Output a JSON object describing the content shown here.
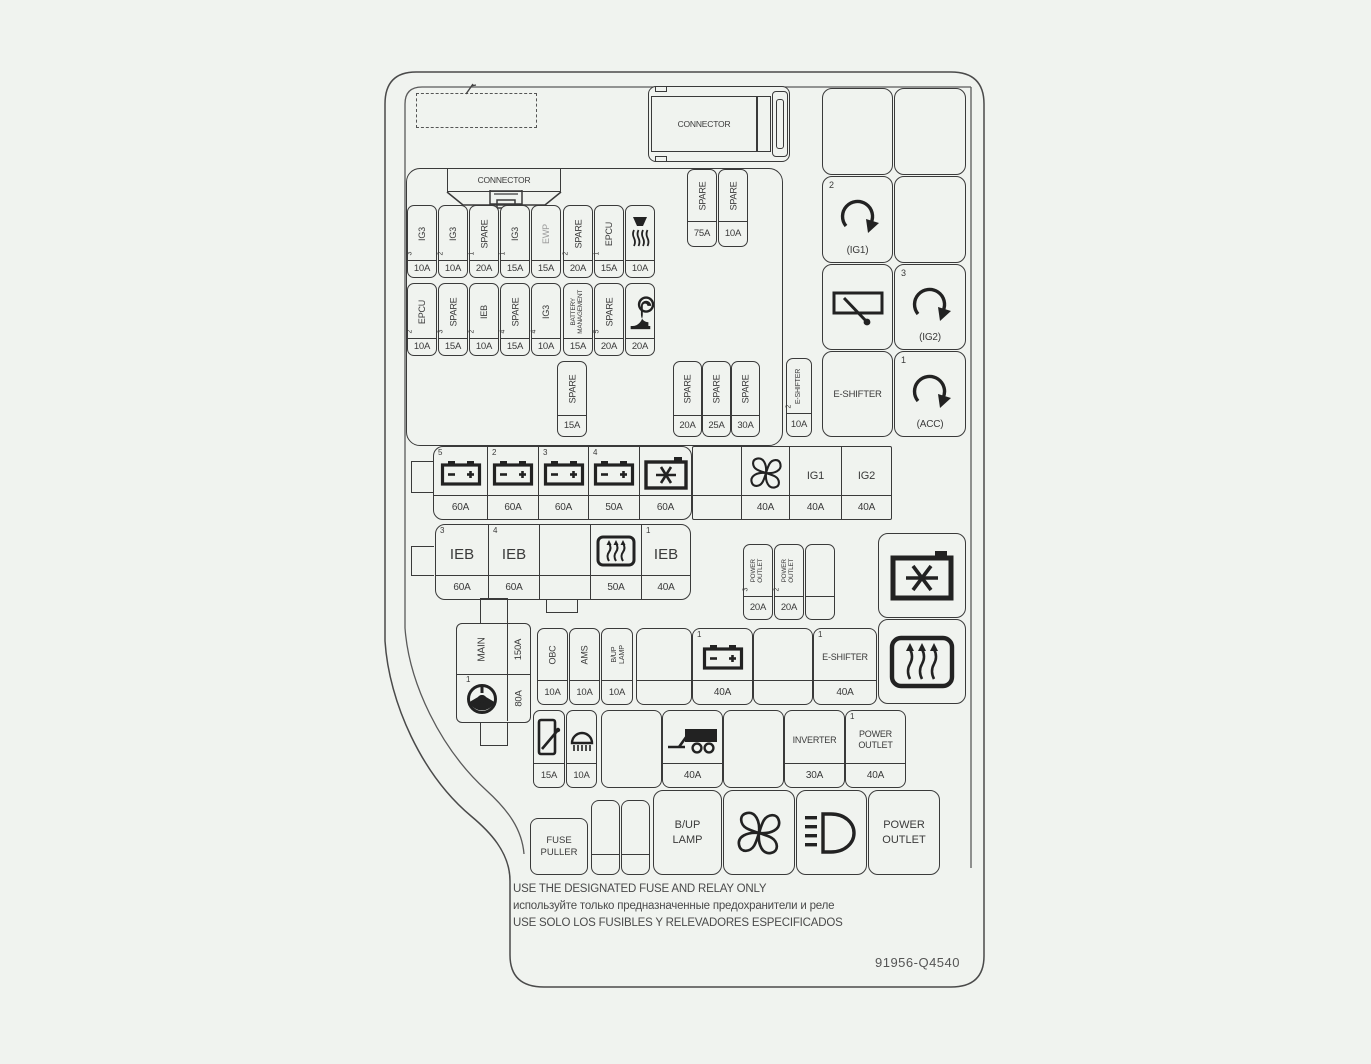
{
  "colors": {
    "background": "#f0f3ef",
    "line": "#3a3a3a",
    "muted_label": "#9a9a9a"
  },
  "connectors": {
    "top_label": "CONNECTOR",
    "inner_label": "CONNECTOR"
  },
  "spare_top": [
    {
      "label": "SPARE",
      "amp": "75A"
    },
    {
      "label": "SPARE",
      "amp": "10A"
    }
  ],
  "row1": [
    {
      "num": "3",
      "label": "IG3",
      "amp": "10A"
    },
    {
      "num": "2",
      "label": "IG3",
      "amp": "10A"
    },
    {
      "num": "1",
      "label": "SPARE",
      "amp": "20A"
    },
    {
      "num": "1",
      "label": "IG3",
      "amp": "15A"
    },
    {
      "num": "",
      "label": "EWP",
      "amp": "15A"
    },
    {
      "num": "2",
      "label": "SPARE",
      "amp": "20A"
    },
    {
      "num": "1",
      "label": "EPCU",
      "amp": "15A"
    },
    {
      "num": "",
      "icon": "washer-nozzle-icon",
      "amp": "10A"
    }
  ],
  "row2": [
    {
      "num": "2",
      "label": "EPCU",
      "amp": "10A"
    },
    {
      "num": "3",
      "label": "SPARE",
      "amp": "15A"
    },
    {
      "num": "2",
      "label": "IEB",
      "amp": "10A"
    },
    {
      "num": "4",
      "label": "SPARE",
      "amp": "15A"
    },
    {
      "num": "4",
      "label": "IG3",
      "amp": "10A"
    },
    {
      "num": "",
      "l1": "BATTERY",
      "l2": "MANAGEMENT",
      "amp": "15A"
    },
    {
      "num": "5",
      "label": "SPARE",
      "amp": "20A"
    },
    {
      "num": "",
      "icon": "horn-icon",
      "amp": "20A"
    }
  ],
  "row3": {
    "spare_single": {
      "label": "SPARE",
      "amp": "15A"
    },
    "spare_group": [
      {
        "label": "SPARE",
        "amp": "20A"
      },
      {
        "label": "SPARE",
        "amp": "25A"
      },
      {
        "label": "SPARE",
        "amp": "30A"
      }
    ],
    "eshifter": {
      "num": "2",
      "label": "E-SHIFTER",
      "amp": "10A"
    }
  },
  "relay_panel": {
    "ig1": {
      "num": "2",
      "label": "(IG1)"
    },
    "ig2": {
      "num": "3",
      "label": "(IG2)"
    },
    "acc": {
      "num": "1",
      "label": "(ACC)"
    },
    "eshifter_label": "E-SHIFTER"
  },
  "row4": {
    "batteries": [
      {
        "num": "5",
        "amp": "60A"
      },
      {
        "num": "2",
        "amp": "60A"
      },
      {
        "num": "3",
        "amp": "60A"
      },
      {
        "num": "4",
        "amp": "50A"
      }
    ],
    "compressor_amp": "60A",
    "fan_amp": "40A",
    "ig1": {
      "label": "IG1",
      "amp": "40A"
    },
    "ig2": {
      "label": "IG2",
      "amp": "40A"
    }
  },
  "row5": {
    "ieb3": {
      "num": "3",
      "label": "IEB",
      "amp": "60A"
    },
    "ieb4": {
      "num": "4",
      "label": "IEB",
      "amp": "60A"
    },
    "defrost_amp": "50A",
    "ieb1": {
      "num": "1",
      "label": "IEB",
      "amp": "40A"
    }
  },
  "power_outlet_fuses": [
    {
      "num": "3",
      "l1": "POWER",
      "l2": "OUTLET",
      "amp": "20A"
    },
    {
      "num": "2",
      "l1": "POWER",
      "l2": "OUTLET",
      "amp": "20A"
    }
  ],
  "main_block": {
    "label": "MAIN",
    "amp_top": "150A",
    "num": "1",
    "amp_bottom": "80A"
  },
  "row6": {
    "obc": {
      "label": "OBC",
      "amp": "10A"
    },
    "ams": {
      "label": "AMS",
      "amp": "10A"
    },
    "bup": {
      "l1": "B/UP",
      "l2": "LAMP",
      "amp": "10A"
    },
    "battery": {
      "num": "1",
      "amp": "40A"
    },
    "eshifter": {
      "num": "1",
      "label": "E-SHIFTER",
      "amp": "40A"
    }
  },
  "row7": {
    "wiper_amp": "15A",
    "lamp_amp": "10A",
    "trailer_amp": "40A",
    "inverter": {
      "label": "INVERTER",
      "amp": "30A"
    },
    "power_outlet": {
      "num": "1",
      "l1": "POWER",
      "l2": "OUTLET",
      "amp": "40A"
    }
  },
  "row8": {
    "fuse_puller": {
      "l1": "FUSE",
      "l2": "PULLER"
    },
    "bup_lamp": {
      "l1": "B/UP",
      "l2": "LAMP"
    },
    "power_outlet": {
      "l1": "POWER",
      "l2": "OUTLET"
    }
  },
  "footer": {
    "line_en": "USE THE DESIGNATED FUSE AND RELAY ONLY",
    "line_ru": "используйте только предназначенные предохранители и реле",
    "line_es": "USE SOLO LOS FUSIBLES Y RELEVADORES ESPECIFICADOS",
    "part_number": "91956-Q4540"
  }
}
